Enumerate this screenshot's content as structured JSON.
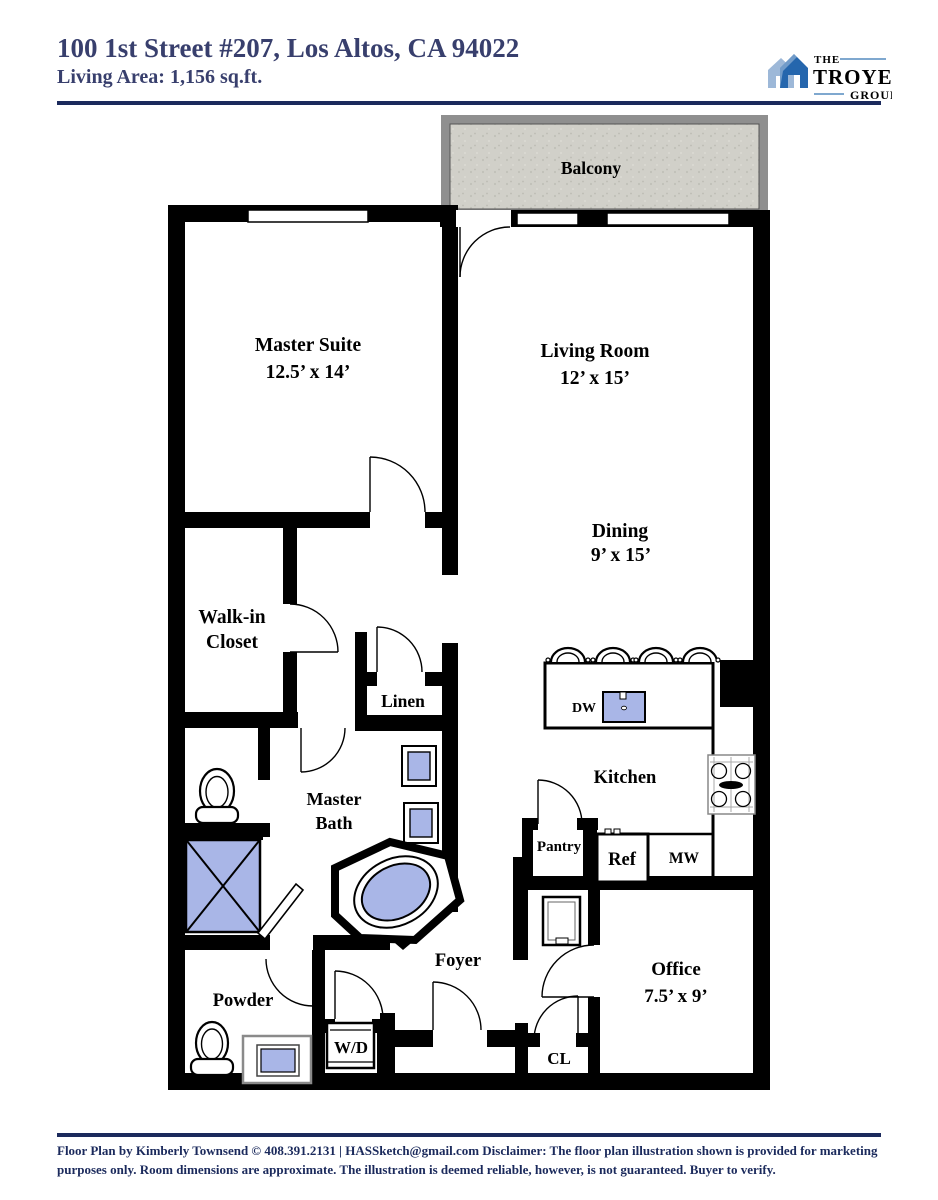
{
  "header": {
    "title": "100 1st Street #207, Los Altos, CA 94022",
    "subtitle": "Living Area: 1,156 sq.ft.",
    "logo": {
      "the": "THE",
      "troyer": "TROYER",
      "group": "GROUP"
    }
  },
  "floorplan": {
    "balcony": {
      "label": "Balcony"
    },
    "master_suite": {
      "name": "Master Suite",
      "dims": "12.5’ x 14’"
    },
    "living_room": {
      "name": "Living Room",
      "dims": "12’ x 15’"
    },
    "dining": {
      "name": "Dining",
      "dims": "9’ x 15’"
    },
    "walk_in_closet": {
      "line1": "Walk-in",
      "line2": "Closet"
    },
    "linen": {
      "label": "Linen"
    },
    "master_bath": {
      "line1": "Master",
      "line2": "Bath"
    },
    "kitchen": {
      "label": "Kitchen"
    },
    "dw": {
      "label": "DW"
    },
    "pantry": {
      "label": "Pantry"
    },
    "ref": {
      "label": "Ref"
    },
    "mw": {
      "label": "MW"
    },
    "foyer": {
      "label": "Foyer"
    },
    "powder": {
      "label": "Powder"
    },
    "wd": {
      "label": "W/D"
    },
    "cl": {
      "label": "CL"
    },
    "office": {
      "name": "Office",
      "dims": "7.5’ x 9’"
    }
  },
  "footer": {
    "text": "Floor Plan by Kimberly Townsend ©  408.391.2131   |   HASSketch@gmail.com  Disclaimer: The floor plan illustration shown is provided for marketing purposes only. Room dimensions are approximate. The illustration is deemed reliable, however, is not guaranteed. Buyer to verify."
  },
  "colors": {
    "navy_text": "#383f6d",
    "rule_navy": "#1b2a5c",
    "wall_black": "#000000",
    "fixture_blue": "#a9b6e7",
    "balcony_fill": "#d1d0c9",
    "balcony_frame": "#8f8f8f",
    "logo_blue": "#1c75bc",
    "logo_light_blue": "#9db8d8",
    "logo_navy": "#223f77"
  }
}
